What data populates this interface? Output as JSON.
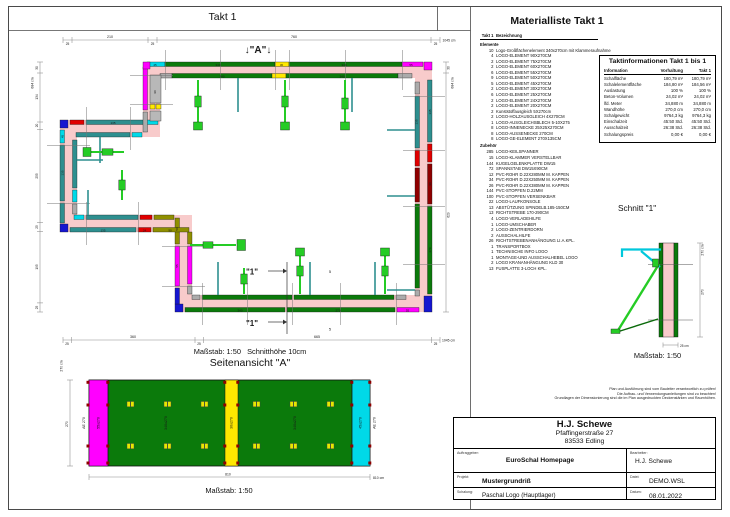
{
  "page": {
    "sheet_title": "Takt 1"
  },
  "plan": {
    "marker_a": "↓\"A\"↓",
    "scale_label": "Maßstab: 1:50",
    "cut_height_label": "Schnitthöhe 10cm",
    "section_marker": "\"1\"",
    "brace_dim": "5",
    "dims_top": [
      "25",
      "210",
      "25",
      "760",
      "25",
      "1045 cm"
    ],
    "dims_bottom": [
      "25",
      "360",
      "25",
      "665",
      "25",
      "1045 cm"
    ],
    "dims_left": [
      "30",
      "684 cm",
      "134",
      "20",
      "255",
      "25",
      "195",
      "25"
    ],
    "dims_right": [
      "30",
      "684 cm",
      "629"
    ],
    "element_labels": [
      "45",
      "340",
      "30",
      "340",
      "55",
      "340",
      "340",
      "135",
      "90",
      "270",
      "135",
      "45",
      "135",
      "135",
      "24",
      "90",
      "50",
      "55",
      "340",
      "270",
      "55",
      "90",
      "135"
    ]
  },
  "elevation": {
    "title": "Seitenansicht \"A\"",
    "scale_label": "Maßstab: 1:50",
    "labels": [
      "AE 270",
      "55x270",
      "340x270",
      "30x270",
      "340x270",
      "45x270",
      "AE 270"
    ],
    "dim_height_total": "270 cm",
    "dim_height": "270",
    "dim_width": "810",
    "dim_width_total": "810 cm"
  },
  "section": {
    "title": "Schnitt \"1\"",
    "scale_label": "Maßstab: 1:50",
    "dim_height_total": "270 cm",
    "dim_height": "270",
    "dim_wall": "25 cm"
  },
  "materials": {
    "title": "Materialliste  Takt 1",
    "col_takt": "Takt 1",
    "col_bezeichnung": "Bezeichnung",
    "group_elements": "Elemente",
    "group_accessories": "Zubehör",
    "elements": [
      {
        "qty": "10",
        "name": "Logo-Großflächenelement 340x270cm mit Klammeraufnahme"
      },
      {
        "qty": "4",
        "name": "LOGO-ELEMENT 90X270CM"
      },
      {
        "qty": "2",
        "name": "LOGO-ELEMENT 75X270CM"
      },
      {
        "qty": "2",
        "name": "LOGO-ELEMENT 60X270CM"
      },
      {
        "qty": "6",
        "name": "LOGO-ELEMENT 55X270CM"
      },
      {
        "qty": "9",
        "name": "LOGO-ELEMENT 50X270CM"
      },
      {
        "qty": "5",
        "name": "LOGO-ELEMENT 45X270CM"
      },
      {
        "qty": "2",
        "name": "LOGO-ELEMENT 30X270CM"
      },
      {
        "qty": "6",
        "name": "LOGO-ELEMENT 25X270CM"
      },
      {
        "qty": "2",
        "name": "LOGO-ELEMENT 24X270CM"
      },
      {
        "qty": "2",
        "name": "LOGO-ELEMENT 20X270CM"
      },
      {
        "qty": "2",
        "name": "Kunststoffausgleich 5X270cm"
      },
      {
        "qty": "2",
        "name": "LOGO-HOLZAUSGLEICH 4X270CM"
      },
      {
        "qty": "1",
        "name": "LOGO-AUSGLEICHSBLECH 5-10X275"
      },
      {
        "qty": "8",
        "name": "LOGO-INNENECKE 25X25X270CM"
      },
      {
        "qty": "8",
        "name": "LOGO-AUSSENECKE 270CM"
      },
      {
        "qty": "8",
        "name": "LOGO-GE-ELEMENT 270X135CM"
      }
    ],
    "accessories": [
      {
        "qty": "285",
        "name": "LOGO-KEILSPANNER"
      },
      {
        "qty": "15",
        "name": "LOGO-KLAMMER VERSTELLBAR"
      },
      {
        "qty": "144",
        "name": "KUGELGELENKPLATTE DW15"
      },
      {
        "qty": "72",
        "name": "SPANNSTAB DW15X90CM"
      },
      {
        "qty": "12",
        "name": "PVC-ROHR D.22X280MM M. KAPPEN"
      },
      {
        "qty": "34",
        "name": "PVC-ROHR D.22X250MM M. KAPPEN"
      },
      {
        "qty": "26",
        "name": "PVC-ROHR D.22X380MM M. KAPPEN"
      },
      {
        "qty": "144",
        "name": "PVC-STOPFEN D.22MM"
      },
      {
        "qty": "100",
        "name": "PVC-STOPFEN VERSENKBAR"
      },
      {
        "qty": "22",
        "name": "LOGO-LAUFKONSOLE"
      },
      {
        "qty": "13",
        "name": "ABSTÜTZUNG SPINDELB.185-150CM"
      },
      {
        "qty": "13",
        "name": "RICHTSTREBE 170-290CM"
      },
      {
        "qty": "4",
        "name": "LOGO-VERLADEHILFE"
      },
      {
        "qty": "1",
        "name": "LOGO-UMSCHABER"
      },
      {
        "qty": "2",
        "name": "LOGO-ZENTRIERDORN"
      },
      {
        "qty": "2",
        "name": "AUSSCHALHILFE"
      },
      {
        "qty": "26",
        "name": "RICHTSTREBENANHÄNGUNG LI.A.KPL."
      },
      {
        "qty": "1",
        "name": "TRANSPORTBOX"
      },
      {
        "qty": "1",
        "name": "TECHNISCHE INFO LOGO"
      },
      {
        "qty": "1",
        "name": "MONTAGE-UND AUSSCHALHEBEL LOGO"
      },
      {
        "qty": "2",
        "name": "LOGO KRANANHÄNGUNG KLD 30"
      },
      {
        "qty": "13",
        "name": "FUSPLATTE 3-LOCH KPL."
      }
    ]
  },
  "takt_info": {
    "title": "Taktinformationen  Takt 1 bis 1",
    "col_information": "Information",
    "col_vorhaltung": "Vorhaltung",
    "col_takt": "Takt 1",
    "rows": [
      {
        "k": "Schalfläche",
        "v": "180,79 m²",
        "t": "180,79 m²"
      },
      {
        "k": "Schalelementfläche",
        "v": "184,80 m²",
        "t": "184,56 m²"
      },
      {
        "k": "Auslastung",
        "v": "100 %",
        "t": "100 %"
      },
      {
        "k": "Beton-Volumen",
        "v": "24,02 m³",
        "t": "24,02 m³"
      },
      {
        "k": "lfd. Meter",
        "v": "34,880 m",
        "t": "34,880 m"
      },
      {
        "k": "Wandhöhe",
        "v": "270,0 cm",
        "t": "270,0 cm"
      },
      {
        "k": "Schalgewicht",
        "v": "9764,3 kg",
        "t": "9764,3 kg"
      },
      {
        "k": "Einschalzeit",
        "v": "45:50 Std.",
        "t": "45:50 Std."
      },
      {
        "k": "Ausschalzeit",
        "v": "26:38 Std.",
        "t": "26:38 Std."
      },
      {
        "k": "Schalungspreis",
        "v": "0,00 €",
        "t": "0,00 €"
      }
    ]
  },
  "notes": [
    "Plan und Ausführung sind vom Bauleiter verantwortlich zu prüfen!",
    "Die Aufbau- und Verwendungsanleitungen sind zu beachten!",
    "Grundlagen der Dimensionierung sind die im Plan ausgedruckten Deckenstärken und Raumhöhen."
  ],
  "title_block": {
    "company": "H.J. Schewe",
    "street": "Pfaffingerstraße 27",
    "city": "83533 Edling",
    "auftraggeber_label": "Auftraggeber:",
    "auftraggeber": "EuroSchal Homepage",
    "bearbeiter_label": "Bearbeiter:",
    "bearbeiter": "H.J. Schewe",
    "projekt_label": "Projekt:",
    "projekt": "Mustergrundriß",
    "datei_label": "Datei:",
    "datei": "DEMO.WSL",
    "schalung_label": "Schalung:",
    "schalung": "Paschal Logo (Hauptlager)",
    "datum_label": "Datum:",
    "datum": "08.01.2022"
  },
  "colors": {
    "wall_fill": "#F8CBCB",
    "panel_green": "#0B7A0B",
    "teal": "#2E8F8F",
    "cyan": "#00D9E8",
    "magenta": "#FF00FF",
    "blue": "#1515D0",
    "red": "#E00000",
    "dark_red": "#8F0000",
    "olive": "#8F8F00",
    "yellow": "#FFE800",
    "brace_green": "#25CC25"
  }
}
